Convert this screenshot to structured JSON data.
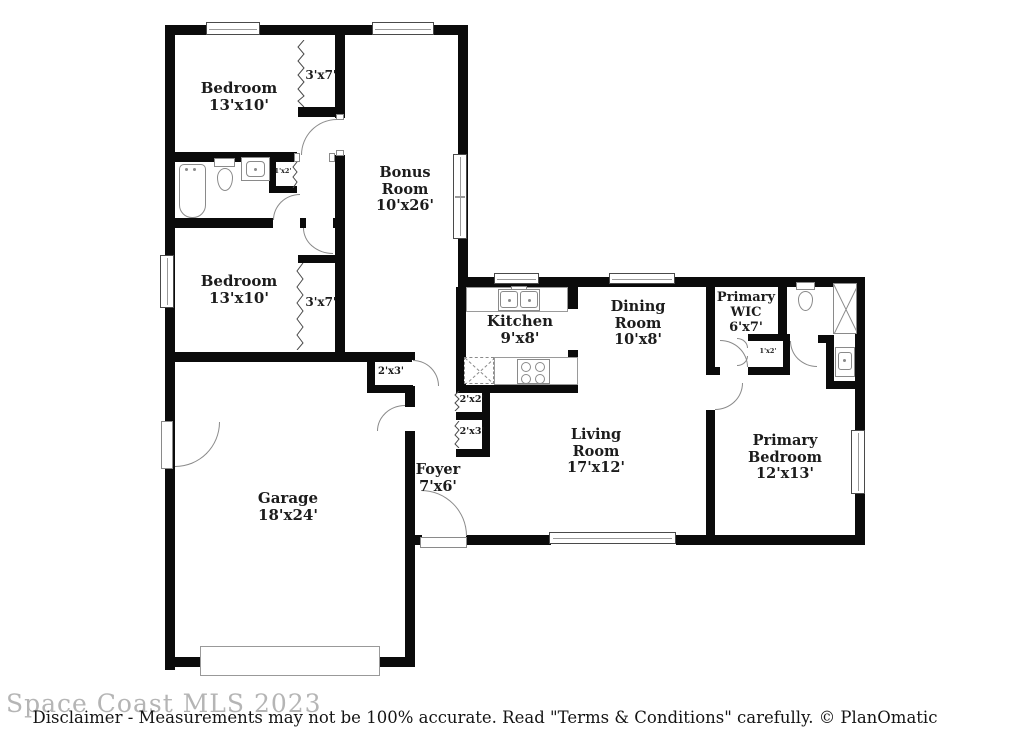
{
  "floor_plan": {
    "rooms": {
      "bedroom1": {
        "name": "Bedroom",
        "dims": "13'x10'"
      },
      "closet1": {
        "dims": "3'x7'"
      },
      "bonus": {
        "name": "Bonus Room",
        "dims": "10'x26'"
      },
      "bedroom2": {
        "name": "Bedroom",
        "dims": "13'x10'"
      },
      "closet2": {
        "dims": "3'x7'"
      },
      "linen1": {
        "dims": "1'x2'"
      },
      "kitchen": {
        "name": "Kitchen",
        "dims": "9'x8'"
      },
      "dining": {
        "name": "Dining Room",
        "dims": "10'x8'"
      },
      "wic": {
        "name": "Primary WIC",
        "dims": "6'x7'"
      },
      "linen2": {
        "dims": "1'x2'"
      },
      "living": {
        "name": "Living Room",
        "dims": "17'x12'"
      },
      "primary_bedroom": {
        "name": "Primary Bedroom",
        "dims": "12'x13'"
      },
      "garage": {
        "name": "Garage",
        "dims": "18'x24'"
      },
      "foyer": {
        "name": "Foyer",
        "dims": "7'x6'"
      },
      "hall_closet": {
        "dims": "2'x3'"
      },
      "closet_2x2": {
        "dims": "2'x2'"
      },
      "closet_2x3": {
        "dims": "2'x3'"
      }
    },
    "footer": {
      "watermark": "Space Coast MLS 2023",
      "disclaimer": "Disclaimer - Measurements may not be 100% accurate. Read \"Terms & Conditions\" carefully. © PlanOmatic"
    },
    "colors": {
      "wall": "#0b0b0b",
      "fixture_stroke": "#8a8a8a",
      "window_stroke": "#4a4a4a",
      "watermark": "#b5b5b5",
      "text": "#1c1c1c",
      "background": "#ffffff"
    }
  }
}
